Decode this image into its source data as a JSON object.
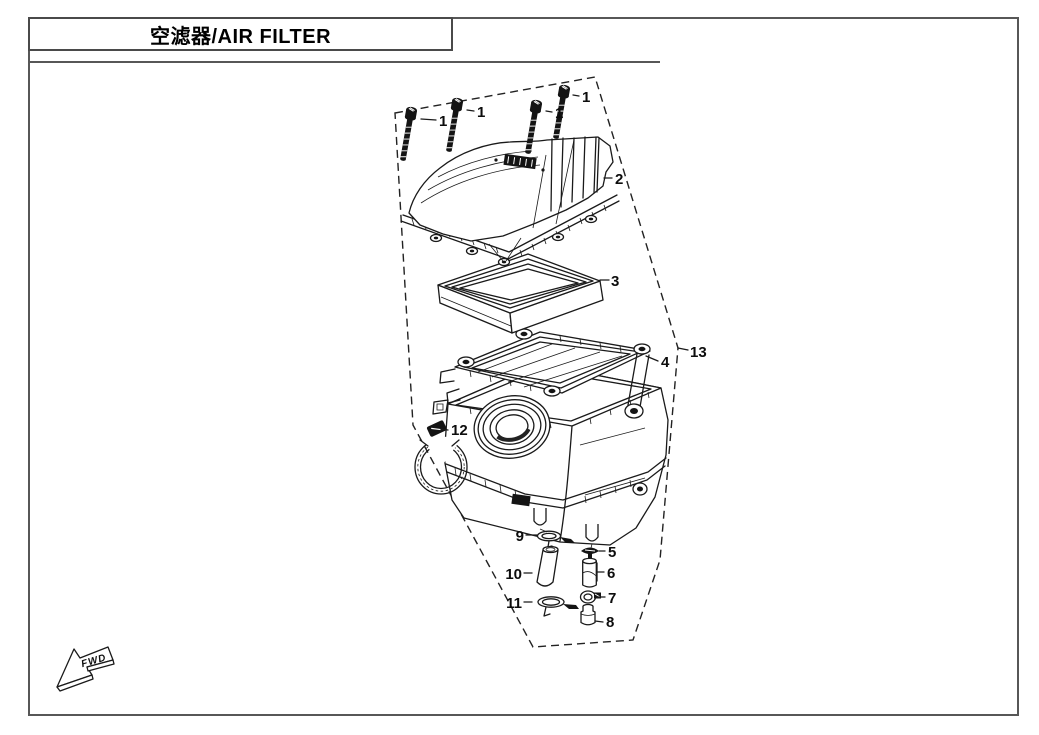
{
  "page": {
    "title": "空滤器/AIR FILTER"
  },
  "diagram": {
    "fwd_label": "FWD",
    "callouts": {
      "c1a": "1",
      "c1b": "1",
      "c1c": "1",
      "c1d": "1",
      "c2": "2",
      "c3": "3",
      "c4": "4",
      "c5": "5",
      "c6": "6",
      "c7": "7",
      "c8": "8",
      "c9": "9",
      "c10": "10",
      "c11": "11",
      "c12": "12",
      "c13": "13"
    }
  }
}
